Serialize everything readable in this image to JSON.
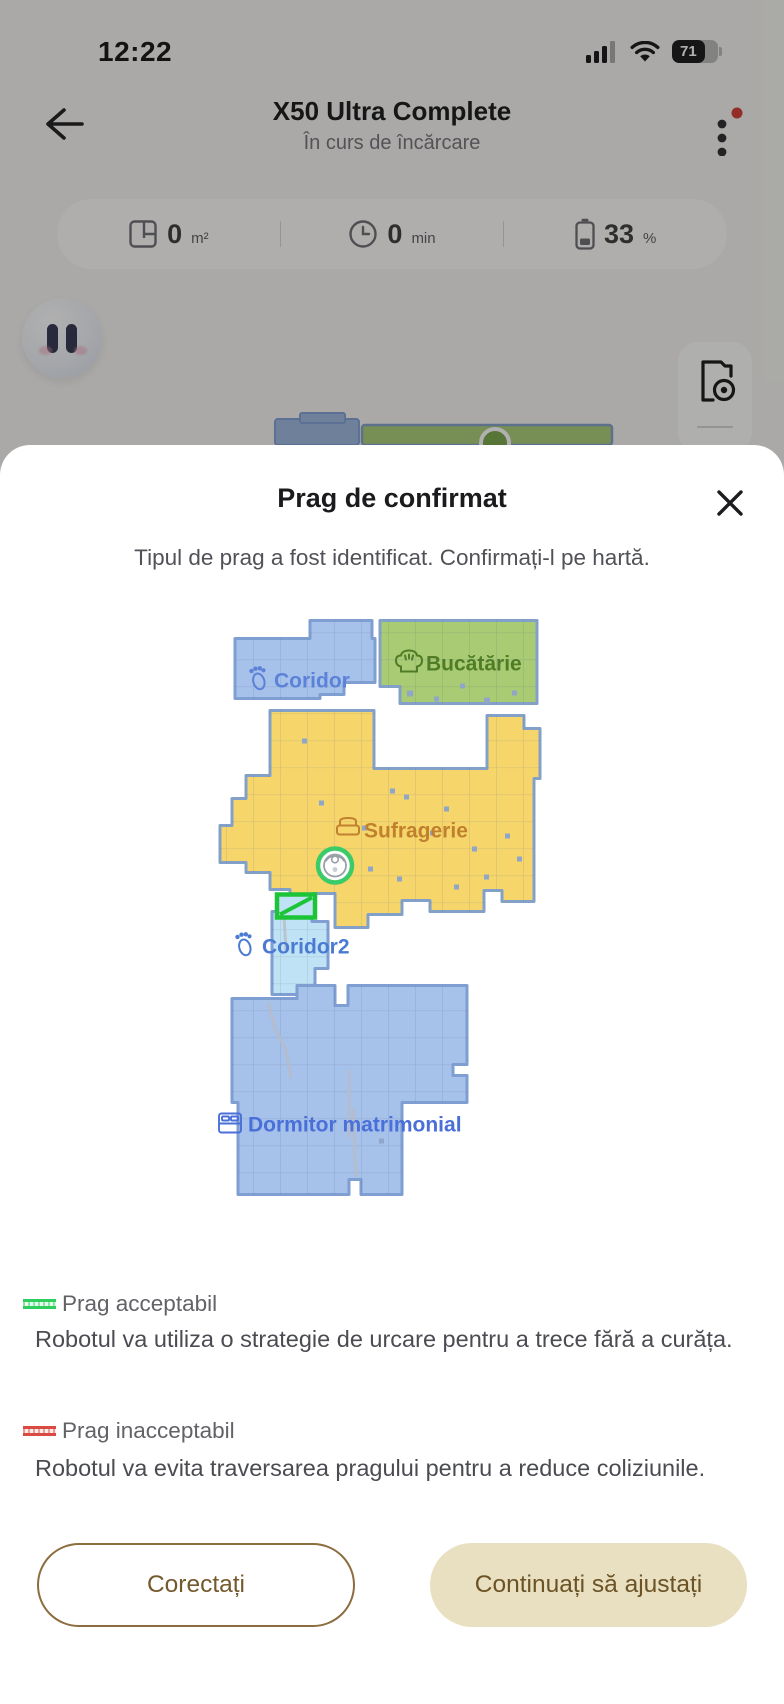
{
  "status_bar": {
    "time": "12:22",
    "battery_percent": "71"
  },
  "header": {
    "title": "X50 Ultra Complete",
    "subtitle": "În curs de încărcare"
  },
  "stats": {
    "area": {
      "value": "0",
      "unit": "m²"
    },
    "runtime": {
      "value": "0",
      "unit": "min"
    },
    "battery": {
      "value": "33",
      "unit": "%"
    }
  },
  "modal": {
    "title": "Prag de confirmat",
    "subtitle": "Tipul de prag a fost identificat. Confirmați-l pe hartă.",
    "legend": [
      {
        "label": "Prag acceptabil",
        "description": "Robotul va utiliza o strategie de urcare pentru a trece fără a curăța.",
        "color": "#2fcf5f"
      },
      {
        "label": "Prag inacceptabil",
        "description": "Robotul va evita traversarea pragului pentru a reduce coliziunile.",
        "color": "#d94a42"
      }
    ],
    "buttons": {
      "secondary": "Corectați",
      "primary": "Continuați să ajustați"
    }
  },
  "map": {
    "room_labels": {
      "coridor": "Coridor",
      "bucatarie": "Bucătărie",
      "sufragerie": "Sufragerie",
      "coridor2": "Coridor2",
      "dormitor": "Dormitor matrimonial"
    },
    "colors": {
      "room_blue": "#a6c1ea",
      "room_green": "#a9cb74",
      "room_yellow": "#f6d66b",
      "room_lightblue": "#bfe3f5",
      "threshold_green": "#1ec437",
      "robot_ring_green": "#3bcb68"
    }
  }
}
